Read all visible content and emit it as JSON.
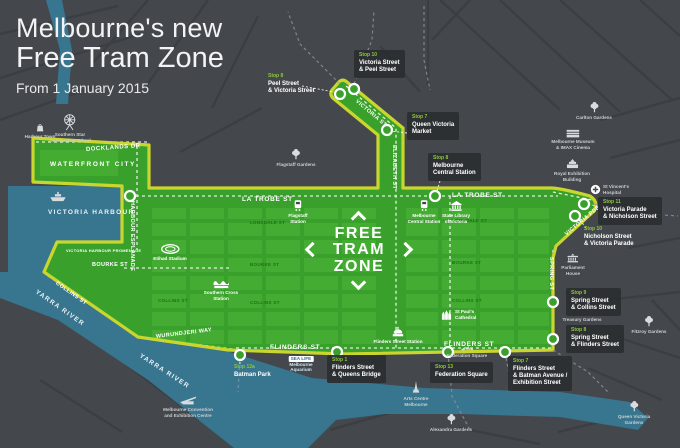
{
  "title": {
    "line1": "Melbourne's new",
    "line2": "Free Tram Zone",
    "subtitle": "From 1 January 2015"
  },
  "logo": {
    "lines": [
      "FREE",
      "TRAM",
      "ZONE"
    ]
  },
  "colors": {
    "background": "#44484d",
    "water": "#38758f",
    "zone_green": "#3aa02c",
    "zone_block_green": "#4cb437",
    "zone_border_lime": "#c9d62e",
    "stop_number_green": "#8dc63f",
    "label_box": "#2a2e32",
    "text_light": "#c9ced2",
    "white": "#ffffff"
  },
  "stops": [
    {
      "number": "Stop 8",
      "lines": [
        "Peel Street",
        "& Victoria Street"
      ],
      "x": 268,
      "y": 74,
      "boxed": false
    },
    {
      "number": "Stop 10",
      "lines": [
        "Victoria Street",
        "& Peel Street"
      ],
      "x": 354,
      "y": 50,
      "boxed": true
    },
    {
      "number": "Stop 7",
      "lines": [
        "Queen Victoria",
        "Market"
      ],
      "x": 407,
      "y": 112,
      "boxed": true
    },
    {
      "number": "Stop 8",
      "lines": [
        "Melbourne",
        "Central Station"
      ],
      "x": 428,
      "y": 153,
      "boxed": true
    },
    {
      "number": "Stop 11",
      "lines": [
        "Victoria Parade",
        "& Nicholson Street"
      ],
      "x": 598,
      "y": 197,
      "boxed": true
    },
    {
      "number": "Stop 10",
      "lines": [
        "Nicholson Street",
        "& Victoria Parade"
      ],
      "x": 584,
      "y": 227,
      "boxed": false
    },
    {
      "number": "Stop 9",
      "lines": [
        "Spring Street",
        "& Collins Street"
      ],
      "x": 566,
      "y": 288,
      "boxed": true
    },
    {
      "number": "Stop 8",
      "lines": [
        "Spring Street",
        "& Flinders Street"
      ],
      "x": 566,
      "y": 325,
      "boxed": true
    },
    {
      "number": "Stop 7",
      "lines": [
        "Flinders Street",
        "& Batman Avenue /",
        "Exhibition Street"
      ],
      "x": 508,
      "y": 356,
      "boxed": true
    },
    {
      "number": "Stop 13",
      "lines": [
        "Federation Square"
      ],
      "x": 430,
      "y": 362,
      "boxed": true
    },
    {
      "number": "Stop 1",
      "lines": [
        "Flinders Street",
        "& Queens Bridge"
      ],
      "x": 327,
      "y": 355,
      "boxed": true
    },
    {
      "number": "Stop 12a",
      "lines": [
        "Batman Park"
      ],
      "x": 234,
      "y": 365,
      "boxed": false
    }
  ],
  "street_labels": [
    {
      "text": "DOCKLANDS DR",
      "x": 86,
      "y": 147,
      "rot": -4,
      "style": "on-zone"
    },
    {
      "text": "WATERFRONT CITY",
      "x": 50,
      "y": 161,
      "rot": 0,
      "style": "on-zone-spaced"
    },
    {
      "text": "VICTORIA HARBOUR",
      "x": 48,
      "y": 209,
      "rot": 0,
      "style": "on-water"
    },
    {
      "text": "YARRA RIVER",
      "x": 36,
      "y": 288,
      "rot": 35,
      "style": "on-water"
    },
    {
      "text": "YARRA RIVER",
      "x": 140,
      "y": 352,
      "rot": 33,
      "style": "on-water"
    },
    {
      "text": "HARBOUR ESPLANADE",
      "x": 132,
      "y": 198,
      "rot": 90,
      "style": "on-zone-small"
    },
    {
      "text": "VICTORIA HARBOUR PROMENADE",
      "x": 66,
      "y": 248,
      "rot": 0,
      "style": "on-zone-tiny"
    },
    {
      "text": "LA TROBE ST",
      "x": 242,
      "y": 196,
      "rot": 0,
      "style": "on-zone-bold"
    },
    {
      "text": "LA TROBE ST",
      "x": 452,
      "y": 192,
      "rot": 0,
      "style": "on-zone-bold"
    },
    {
      "text": "ELIZABETH ST",
      "x": 394,
      "y": 142,
      "rot": 90,
      "style": "on-zone-small"
    },
    {
      "text": "VICTORIA ST",
      "x": 356,
      "y": 98,
      "rot": 40,
      "style": "on-zone-small"
    },
    {
      "text": "VICTORIA PDE",
      "x": 566,
      "y": 232,
      "rot": -40,
      "style": "on-zone-small"
    },
    {
      "text": "SPRING ST",
      "x": 551,
      "y": 254,
      "rot": 90,
      "style": "on-zone-small"
    },
    {
      "text": "FLINDERS ST",
      "x": 270,
      "y": 344,
      "rot": 0,
      "style": "on-zone-bold"
    },
    {
      "text": "FLINDERS ST",
      "x": 444,
      "y": 341,
      "rot": 0,
      "style": "on-zone-bold"
    },
    {
      "text": "WURUNDJERI WAY",
      "x": 156,
      "y": 334,
      "rot": -7,
      "style": "on-zone-small"
    },
    {
      "text": "BOURKE ST",
      "x": 92,
      "y": 262,
      "rot": 0,
      "style": "on-zone-small"
    },
    {
      "text": "COLLINS ST",
      "x": 56,
      "y": 280,
      "rot": 35,
      "style": "on-zone-small"
    },
    {
      "text": "COLLINS ST",
      "x": 158,
      "y": 298,
      "rot": 0,
      "style": "inner"
    },
    {
      "text": "LONSDALE ST",
      "x": 250,
      "y": 220,
      "rot": 0,
      "style": "inner"
    },
    {
      "text": "LONSDALE ST",
      "x": 452,
      "y": 218,
      "rot": 0,
      "style": "inner"
    },
    {
      "text": "BOURKE ST",
      "x": 250,
      "y": 262,
      "rot": 0,
      "style": "inner"
    },
    {
      "text": "BOURKE ST",
      "x": 452,
      "y": 260,
      "rot": 0,
      "style": "inner"
    },
    {
      "text": "COLLINS ST",
      "x": 250,
      "y": 300,
      "rot": 0,
      "style": "inner"
    },
    {
      "text": "COLLINS ST",
      "x": 452,
      "y": 298,
      "rot": 0,
      "style": "inner"
    }
  ],
  "landmarks": [
    {
      "icon": "shopping-bag",
      "lines": [
        "Harbour Town"
      ],
      "x": 40,
      "y": 122,
      "on": "dark"
    },
    {
      "icon": "ferris-wheel",
      "lines": [
        "Southern Star",
        "Observation Wheel"
      ],
      "x": 70,
      "y": 112,
      "on": "dark"
    },
    {
      "icon": "ship",
      "lines": [],
      "x": 58,
      "y": 191,
      "on": "dark"
    },
    {
      "icon": "stadium",
      "lines": [
        "Etihad Stadium"
      ],
      "x": 170,
      "y": 243,
      "on": "green"
    },
    {
      "icon": "station",
      "lines": [
        "Southern Cross",
        "Station"
      ],
      "x": 221,
      "y": 278,
      "on": "green"
    },
    {
      "icon": "train",
      "lines": [
        "Flagstaff",
        "Station"
      ],
      "x": 298,
      "y": 199,
      "on": "green"
    },
    {
      "icon": "train",
      "lines": [
        "Melbourne",
        "Central Station"
      ],
      "x": 424,
      "y": 199,
      "on": "green"
    },
    {
      "icon": "columns",
      "lines": [
        "State Library",
        "of Victoria"
      ],
      "x": 456,
      "y": 199,
      "on": "green"
    },
    {
      "icon": "tree",
      "lines": [
        "Flagstaff Gardens"
      ],
      "x": 296,
      "y": 148,
      "on": "dark"
    },
    {
      "icon": "tree",
      "lines": [
        "Carlton Gardens"
      ],
      "x": 594,
      "y": 101,
      "on": "dark"
    },
    {
      "icon": "museum",
      "lines": [
        "Melbourne Museum",
        "& IMAX Cinema"
      ],
      "x": 573,
      "y": 128,
      "on": "dark"
    },
    {
      "icon": "exhibition",
      "lines": [
        "Royal Exhibition",
        "Building"
      ],
      "x": 572,
      "y": 157,
      "on": "dark"
    },
    {
      "icon": "hospital",
      "lines": [
        "St Vincent's",
        "Hospital"
      ],
      "x": 590,
      "y": 184,
      "on": "dark",
      "layout": "row"
    },
    {
      "icon": "parliament",
      "lines": [
        "Parliament",
        "House"
      ],
      "x": 573,
      "y": 251,
      "on": "dark"
    },
    {
      "icon": "none",
      "lines": [
        "Treasury Gardens"
      ],
      "x": 582,
      "y": 317,
      "on": "dark"
    },
    {
      "icon": "tree",
      "lines": [
        "Fitzroy Gardens"
      ],
      "x": 649,
      "y": 315,
      "on": "dark"
    },
    {
      "icon": "cathedral",
      "lines": [
        "St Paul's",
        "Cathedral"
      ],
      "x": 440,
      "y": 308,
      "on": "green",
      "layout": "row"
    },
    {
      "icon": "dome",
      "lines": [
        "Flinders Street Station"
      ],
      "x": 398,
      "y": 325,
      "on": "green"
    },
    {
      "icon": "none",
      "lines": [
        "SEA LIFE",
        "Melbourne",
        "Aquarium"
      ],
      "x": 301,
      "y": 356,
      "on": "dark",
      "cls": "lm-sealife"
    },
    {
      "icon": "spire",
      "lines": [
        "Arts Centre",
        "Melbourne"
      ],
      "x": 416,
      "y": 380,
      "on": "dark"
    },
    {
      "icon": "fedsq",
      "lines": [
        "Federation Square"
      ],
      "x": 467,
      "y": 343,
      "on": "dark"
    },
    {
      "icon": "tree",
      "lines": [
        "Alexandra Gardens"
      ],
      "x": 451,
      "y": 413,
      "on": "dark"
    },
    {
      "icon": "convention",
      "lines": [
        "Melbourne Convention",
        "and Exhibition Centre"
      ],
      "x": 188,
      "y": 395,
      "on": "dark"
    },
    {
      "icon": "tree",
      "lines": [
        "Queen Victoria",
        "Gardens"
      ],
      "x": 634,
      "y": 400,
      "on": "dark"
    }
  ]
}
